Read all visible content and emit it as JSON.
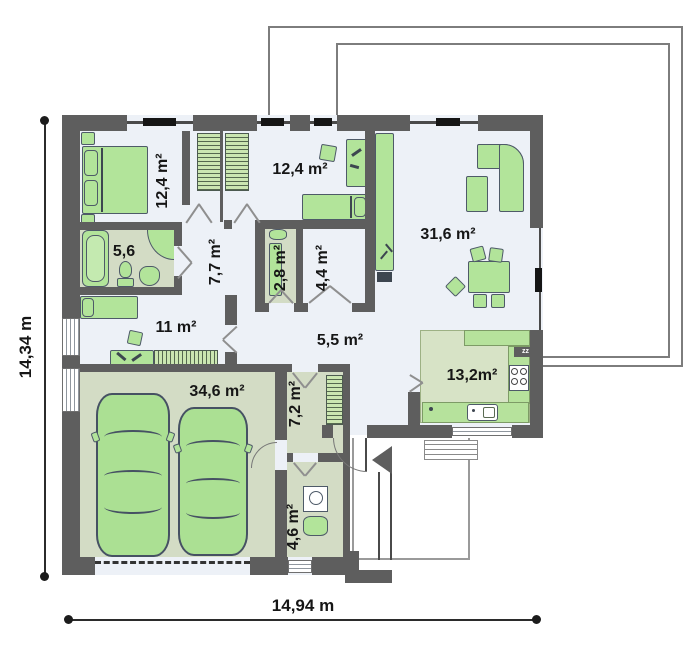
{
  "plan": {
    "type": "floor-plan",
    "dimension_labels": {
      "height": "14,34 m",
      "width": "14,94 m"
    },
    "rooms": [
      {
        "id": "bedroom-1",
        "area": "12,4 m²"
      },
      {
        "id": "bedroom-2",
        "area": "12,4 m²"
      },
      {
        "id": "living-room",
        "area": "31,6 m²"
      },
      {
        "id": "bathroom",
        "area": "5,6"
      },
      {
        "id": "hallway",
        "area": "7,7 m²"
      },
      {
        "id": "wc",
        "area": "2,8 m²"
      },
      {
        "id": "pantry",
        "area": "4,4 m²"
      },
      {
        "id": "bedroom-3",
        "area": "11 m²"
      },
      {
        "id": "corridor",
        "area": "5,5 m²"
      },
      {
        "id": "kitchen",
        "area": "13,2m²"
      },
      {
        "id": "garage",
        "area": "34,6 m²"
      },
      {
        "id": "utility-room",
        "area": "7,2 m²"
      },
      {
        "id": "laundry",
        "area": "4,6 m²"
      }
    ],
    "kitchen_badge": "zz",
    "colors": {
      "wall": "#5e5e5e",
      "floor_light": "#edf1f7",
      "floor_green": "#d3dcc5",
      "kitchen_floor": "#d7e3c6",
      "counter": "#b6e29c",
      "furniture": "#b2e49a",
      "furniture_outline": "#4e5a68",
      "terrace_line": "#7d7d7d",
      "text": "#161616"
    }
  }
}
